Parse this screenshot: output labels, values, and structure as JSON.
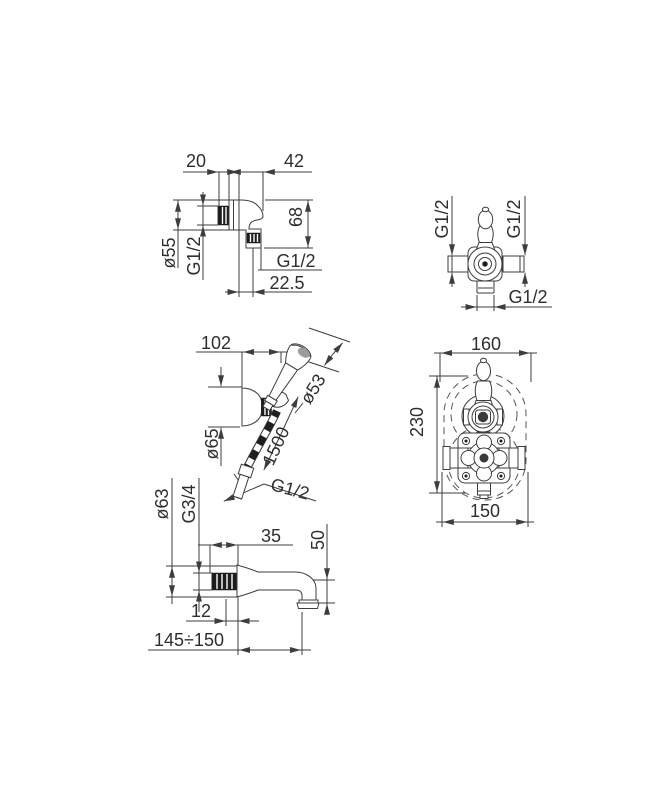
{
  "colors": {
    "background": "#ffffff",
    "line": "#3d3d3d",
    "text": "#2e2e2e",
    "thread_fill": "#1c1c1c"
  },
  "views": {
    "wall_union": {
      "dims": {
        "thread_length": "20",
        "projection": "42",
        "height": "68",
        "flange_diameter": "ø55",
        "inlet_thread": "G1/2",
        "outlet_thread": "G1/2",
        "outlet_offset": "22.5"
      }
    },
    "valve_trim": {
      "dims": {
        "left_connection": "G1/2",
        "right_connection": "G1/2",
        "bottom_connection": "G1/2"
      }
    },
    "hand_shower": {
      "dims": {
        "bracket_projection": "102",
        "head_diameter": "ø53",
        "hose_length": "1500",
        "bracket_diameter": "ø65",
        "hose_connection": "G1/2"
      }
    },
    "thermostat_rough_in": {
      "dims": {
        "recess_width": "160",
        "recess_height": "230",
        "body_width": "150"
      }
    },
    "bath_spout": {
      "dims": {
        "flange_diameter": "ø63",
        "connection_thread": "G3/4",
        "flange_depth": "35",
        "outlet_drop": "50",
        "thread_length": "12",
        "projection": "145÷150"
      }
    }
  }
}
